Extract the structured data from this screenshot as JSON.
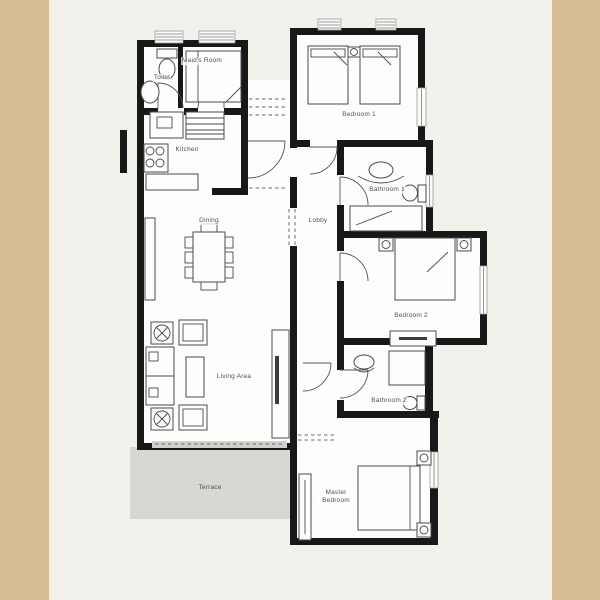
{
  "page_type": "apartment-floor-plan",
  "colors": {
    "background": "#f2f1ec",
    "side-panel": "#d6bc92",
    "wall": "#181818",
    "floor": "#fdfdfb",
    "terrace": "#d6d9d3",
    "label-text": "#4f4f4f"
  },
  "floorplan": {
    "rooms": [
      {
        "id": "toilet",
        "label": "Toilet"
      },
      {
        "id": "maids-room",
        "label": "Maid's Room"
      },
      {
        "id": "kitchen",
        "label": "Kitchen"
      },
      {
        "id": "dining",
        "label": "Dining"
      },
      {
        "id": "lobby",
        "label": "Lobby"
      },
      {
        "id": "living-area",
        "label": "Living Area"
      },
      {
        "id": "terrace",
        "label": "Terrace"
      },
      {
        "id": "bedroom-1",
        "label": "Bedroom 1"
      },
      {
        "id": "bathroom-1",
        "label": "Bathroom 1"
      },
      {
        "id": "bedroom-2",
        "label": "Bedroom 2"
      },
      {
        "id": "bathroom-2",
        "label": "Bathroom 2"
      },
      {
        "id": "master-bedroom",
        "label": "Master Bedroom"
      }
    ]
  }
}
